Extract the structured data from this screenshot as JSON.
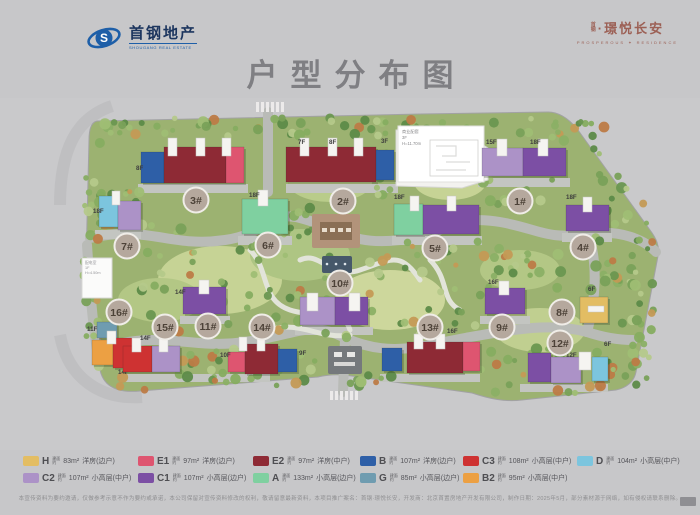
{
  "header": {
    "brand_left": {
      "name_cn": "首钢地产",
      "name_en": "SHOUGANG REAL ESTATE",
      "emblem_letter": "S",
      "brand_color": "#1e5fa8"
    },
    "brand_right": {
      "prefix_top": "首",
      "prefix_bottom": "钢",
      "name_cn": "·璟悦长安",
      "en_left": "PROSPEROUS",
      "en_right": "RESIDENCE",
      "brand_color": "#9c6055"
    }
  },
  "title": {
    "cn": "户型分布图",
    "en": "PROSPEROUS RESIDENCE"
  },
  "unit_colors": {
    "H": "#e3bd63",
    "E1": "#de5570",
    "E2": "#8e2a35",
    "B": "#2e5fa7",
    "C3": "#ce3232",
    "D": "#7cc5de",
    "C2": "#ac92c7",
    "C1": "#7c4fa4",
    "A": "#7fd0a0",
    "G": "#6f9cb0",
    "B2": "#eca043"
  },
  "site_plan": {
    "label_circle_color": "#b5a89d",
    "buildings": [
      {
        "id": "3#",
        "circle": [
          196,
          200
        ],
        "floors": [
          {
            "t": "8F",
            "x": 136,
            "y": 170
          }
        ],
        "blocks": [
          {
            "u": "B",
            "x": 141,
            "y": 152,
            "w": 23,
            "h": 31
          },
          {
            "u": "E2",
            "x": 164,
            "y": 147,
            "w": 62,
            "h": 36
          },
          {
            "u": "E1",
            "x": 226,
            "y": 147,
            "w": 18,
            "h": 36
          }
        ],
        "cores": [
          [
            168,
            138,
            9,
            18
          ],
          [
            196,
            138,
            9,
            18
          ],
          [
            222,
            138,
            9,
            18
          ]
        ]
      },
      {
        "id": "2#",
        "circle": [
          343,
          201
        ],
        "floors": [
          {
            "t": "7F",
            "x": 298,
            "y": 144
          },
          {
            "t": "8F",
            "x": 329,
            "y": 144
          }
        ],
        "blocks": [
          {
            "u": "E2",
            "x": 286,
            "y": 147,
            "w": 90,
            "h": 35
          },
          {
            "u": "B",
            "x": 376,
            "y": 150,
            "w": 18,
            "h": 30
          }
        ],
        "cores": [
          [
            300,
            138,
            9,
            18
          ],
          [
            328,
            138,
            9,
            18
          ],
          [
            354,
            138,
            9,
            18
          ]
        ]
      },
      {
        "id": "1#",
        "circle": [
          520,
          201
        ],
        "floors": [
          {
            "t": "15F",
            "x": 486,
            "y": 144
          },
          {
            "t": "18F",
            "x": 530,
            "y": 144
          }
        ],
        "blocks": [
          {
            "u": "C2",
            "x": 482,
            "y": 148,
            "w": 41,
            "h": 28
          },
          {
            "u": "C1",
            "x": 523,
            "y": 148,
            "w": 43,
            "h": 28
          }
        ],
        "cores": [
          [
            497,
            139,
            10,
            17
          ],
          [
            538,
            139,
            10,
            17
          ]
        ]
      },
      {
        "id": "7#",
        "circle": [
          127,
          246
        ],
        "floors": [
          {
            "t": "18F",
            "x": 93,
            "y": 213
          }
        ],
        "blocks": [
          {
            "u": "D",
            "x": 99,
            "y": 196,
            "w": 19,
            "h": 31
          },
          {
            "u": "C2",
            "x": 118,
            "y": 201,
            "w": 23,
            "h": 29
          }
        ],
        "cores": [
          [
            112,
            191,
            8,
            14
          ]
        ]
      },
      {
        "id": "6#",
        "circle": [
          268,
          245
        ],
        "floors": [
          {
            "t": "18F",
            "x": 249,
            "y": 197
          }
        ],
        "blocks": [
          {
            "u": "A",
            "x": 242,
            "y": 199,
            "w": 46,
            "h": 35
          }
        ],
        "cores": [
          [
            258,
            190,
            10,
            16
          ]
        ]
      },
      {
        "id": "5#",
        "circle": [
          435,
          248
        ],
        "floors": [
          {
            "t": "18F",
            "x": 394,
            "y": 199
          }
        ],
        "blocks": [
          {
            "u": "A",
            "x": 394,
            "y": 204,
            "w": 29,
            "h": 31
          },
          {
            "u": "C1",
            "x": 423,
            "y": 205,
            "w": 56,
            "h": 29
          }
        ],
        "cores": [
          [
            410,
            196,
            9,
            15
          ],
          [
            447,
            196,
            9,
            15
          ]
        ]
      },
      {
        "id": "4#",
        "circle": [
          583,
          247
        ],
        "floors": [
          {
            "t": "18F",
            "x": 566,
            "y": 199
          }
        ],
        "blocks": [
          {
            "u": "C1",
            "x": 566,
            "y": 205,
            "w": 43,
            "h": 26
          }
        ],
        "cores": [
          [
            583,
            197,
            9,
            15
          ]
        ]
      },
      {
        "id": "16#",
        "circle": [
          119,
          312
        ],
        "floors": [
          {
            "t": "11F",
            "x": 87,
            "y": 331
          },
          {
            "t": "14F",
            "x": 118,
            "y": 374
          }
        ],
        "blocks": [
          {
            "u": "G",
            "x": 97,
            "y": 322,
            "w": 20,
            "h": 16
          },
          {
            "u": "B2",
            "x": 92,
            "y": 340,
            "w": 21,
            "h": 25
          },
          {
            "u": "C3",
            "x": 113,
            "y": 338,
            "w": 25,
            "h": 30
          }
        ],
        "cores": [
          [
            107,
            331,
            9,
            13
          ]
        ]
      },
      {
        "id": "15#",
        "circle": [
          165,
          327
        ],
        "floors": [
          {
            "t": "14F",
            "x": 140,
            "y": 340
          }
        ],
        "blocks": [
          {
            "u": "C3",
            "x": 123,
            "y": 346,
            "w": 29,
            "h": 26
          },
          {
            "u": "C2",
            "x": 152,
            "y": 346,
            "w": 28,
            "h": 26
          }
        ],
        "cores": [
          [
            132,
            338,
            9,
            14
          ],
          [
            159,
            338,
            9,
            14
          ]
        ]
      },
      {
        "id": "11#",
        "circle": [
          208,
          326
        ],
        "floors": [
          {
            "t": "14F",
            "x": 175,
            "y": 294
          }
        ],
        "blocks": [
          {
            "u": "C1",
            "x": 183,
            "y": 287,
            "w": 43,
            "h": 27
          }
        ],
        "cores": [
          [
            199,
            280,
            10,
            14
          ]
        ]
      },
      {
        "id": "14#",
        "circle": [
          262,
          327
        ],
        "floors": [
          {
            "t": "10F",
            "x": 220,
            "y": 357
          },
          {
            "t": "9F",
            "x": 299,
            "y": 355
          }
        ],
        "blocks": [
          {
            "u": "E1",
            "x": 228,
            "y": 352,
            "w": 17,
            "h": 20
          },
          {
            "u": "E2",
            "x": 245,
            "y": 344,
            "w": 33,
            "h": 30
          },
          {
            "u": "B",
            "x": 278,
            "y": 349,
            "w": 19,
            "h": 23
          }
        ],
        "cores": [
          [
            239,
            337,
            8,
            14
          ],
          [
            257,
            337,
            8,
            14
          ]
        ]
      },
      {
        "id": "10#",
        "circle": [
          340,
          283
        ],
        "floors": [],
        "blocks": [
          {
            "u": "C2",
            "x": 300,
            "y": 297,
            "w": 35,
            "h": 28
          },
          {
            "u": "C1",
            "x": 335,
            "y": 297,
            "w": 33,
            "h": 28
          }
        ],
        "cores": [
          [
            307,
            293,
            11,
            18
          ],
          [
            349,
            293,
            11,
            18
          ]
        ]
      },
      {
        "id": "13#",
        "circle": [
          430,
          327
        ],
        "floors": [
          {
            "t": "16F",
            "x": 447,
            "y": 333
          }
        ],
        "blocks": [
          {
            "u": "B",
            "x": 382,
            "y": 348,
            "w": 20,
            "h": 23
          },
          {
            "u": "E2",
            "x": 407,
            "y": 342,
            "w": 56,
            "h": 31
          },
          {
            "u": "E1",
            "x": 463,
            "y": 342,
            "w": 17,
            "h": 29
          }
        ],
        "cores": [
          [
            414,
            334,
            9,
            15
          ],
          [
            436,
            334,
            9,
            15
          ]
        ]
      },
      {
        "id": "9#",
        "circle": [
          502,
          327
        ],
        "floors": [
          {
            "t": "16F",
            "x": 488,
            "y": 284
          }
        ],
        "blocks": [
          {
            "u": "C1",
            "x": 485,
            "y": 288,
            "w": 40,
            "h": 26
          }
        ],
        "cores": [
          [
            499,
            281,
            10,
            14
          ]
        ]
      },
      {
        "id": "8#",
        "circle": [
          562,
          312
        ],
        "floors": [
          {
            "t": "6F",
            "x": 588,
            "y": 291
          }
        ],
        "blocks": [
          {
            "u": "H",
            "x": 580,
            "y": 297,
            "w": 28,
            "h": 26
          }
        ],
        "cores": [
          [
            588,
            306,
            16,
            6
          ]
        ]
      },
      {
        "id": "12#",
        "circle": [
          560,
          343
        ],
        "floors": [
          {
            "t": "12F",
            "x": 566,
            "y": 357
          },
          {
            "t": "6F",
            "x": 604,
            "y": 346
          }
        ],
        "blocks": [
          {
            "u": "C1",
            "x": 528,
            "y": 353,
            "w": 23,
            "h": 29
          },
          {
            "u": "C2",
            "x": 551,
            "y": 357,
            "w": 30,
            "h": 26
          },
          {
            "u": "D",
            "x": 592,
            "y": 357,
            "w": 16,
            "h": 24
          }
        ],
        "cores": [
          [
            579,
            352,
            12,
            18
          ]
        ]
      }
    ],
    "annotations": {
      "commercial": {
        "floor_label": "3F",
        "callout_lines": [
          "商业配套",
          "3F",
          "H=11.70m"
        ]
      },
      "utility": {
        "lines": [
          "配电室",
          "1F",
          "H=4.50m"
        ]
      }
    }
  },
  "legend": {
    "prefix_top": "建面",
    "prefix_bottom": "约",
    "rows": [
      [
        {
          "code": "H",
          "area": "83m²",
          "type": "洋房(边户)"
        },
        {
          "code": "E1",
          "area": "97m²",
          "type": "洋房(边户)"
        },
        {
          "code": "E2",
          "area": "97m²",
          "type": "洋房(中户)"
        },
        {
          "code": "B",
          "area": "107m²",
          "type": "洋房(边户)"
        },
        {
          "code": "C3",
          "area": "108m²",
          "type": "小高层(中户)"
        },
        {
          "code": "D",
          "area": "104m²",
          "type": "小高层(中户)"
        }
      ],
      [
        {
          "code": "C2",
          "area": "107m²",
          "type": "小高层(中户)"
        },
        {
          "code": "C1",
          "area": "107m²",
          "type": "小高层(边户)"
        },
        {
          "code": "A",
          "area": "133m²",
          "type": "小高层(边户)"
        },
        {
          "code": "G",
          "area": "85m²",
          "type": "小高层(边户)"
        },
        {
          "code": "B2",
          "area": "95m²",
          "type": "小高层(中户)"
        }
      ]
    ]
  },
  "footer": {
    "disclaimer": "本宣传资料为要约邀请，仅做参考示意不作为要约或承诺，本公司保留对宣传资料修改的权利，敬请留意最新资料，本项目推广案名：首钢·璟悦长安，开发商：北京首置房地产开发有限公司，制作日期：2025年5月，部分素材源于网络，如有侵权请联系删除。"
  }
}
